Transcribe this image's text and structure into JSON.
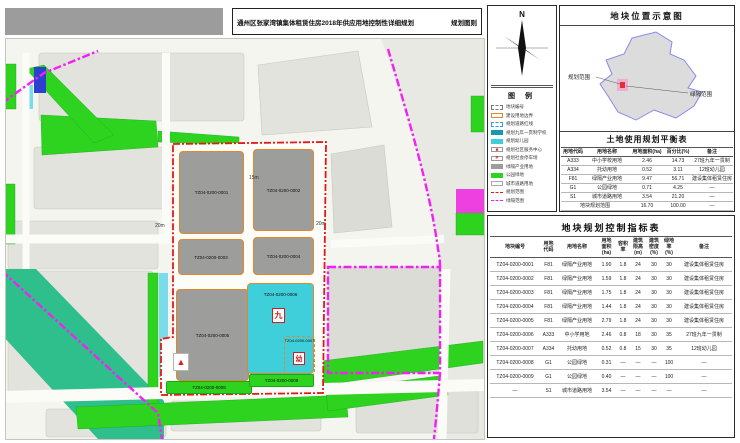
{
  "title_bar": {
    "title": "通州区张家湾镇集体租赁住房2018年供应用地控制性详细规划",
    "right_label": "规划图则"
  },
  "compass": {
    "n": "N"
  },
  "legend": {
    "title": "图  例",
    "items": [
      {
        "label": "地块编号",
        "sw": "sw-dash"
      },
      {
        "label": "建设用地边界",
        "sw": "sw-orange"
      },
      {
        "label": "规划道路红线",
        "sw": "sw-cyan-dash"
      },
      {
        "label": "规划九年一贯制学校",
        "sw": "sw-teal-dark"
      },
      {
        "label": "规划幼儿园",
        "sw": "sw-teal"
      },
      {
        "label": "规划社区服务中心",
        "sw": "sw-mark",
        "glyph": "■"
      },
      {
        "label": "规划社会停车场",
        "sw": "sw-mark",
        "glyph": "P"
      },
      {
        "label": "绿隔产业用地",
        "sw": "sw-gray"
      },
      {
        "label": "公园绿地",
        "sw": "sw-green"
      },
      {
        "label": "城市道路用地",
        "sw": "sw-road"
      },
      {
        "label": "规划范围",
        "sw": "sw-red-line"
      },
      {
        "label": "绿隔范围",
        "sw": "sw-magenta-line"
      }
    ]
  },
  "location_map": {
    "title": "地块位置示意图",
    "label_planning": "规划范围",
    "label_greenbelt": "绿隔范围"
  },
  "balance_table": {
    "title": "土地使用规划平衡表",
    "headers": [
      "用地代码",
      "用地名称",
      "用地面积(ha)",
      "百分比(%)",
      "备注"
    ],
    "rows": [
      [
        "A333",
        "中小学校用地",
        "2.46",
        "14.73",
        "27班九年一贯制"
      ],
      [
        "A334",
        "托幼用地",
        "0.52",
        "3.11",
        "12班幼儿园"
      ],
      [
        "F81",
        "绿隔产业用地",
        "9.47",
        "56.71",
        "建设集体租赁住房"
      ],
      [
        "G1",
        "公园绿地",
        "0.71",
        "4.25",
        "—"
      ],
      [
        "S1",
        "城市道路用地",
        "3.54",
        "21.20",
        "—"
      ],
      [
        {
          "t": "地块规划范围",
          "cs": 2
        },
        "16.70",
        "100.00",
        "—"
      ]
    ]
  },
  "index_table": {
    "title": "地块规划控制指标表",
    "headers": [
      "地块编号",
      "用地\n代码",
      "用地名称",
      "用地\n面积\n(ha)",
      "容积\n率",
      "建筑\n限高\n(m)",
      "建筑\n密度\n(%)",
      "绿地\n率\n(%)",
      "备注"
    ],
    "rows": [
      [
        "TZ04-0200-0001",
        "F81",
        "绿隔产业用地",
        "1.90",
        "1.8",
        "24",
        "30",
        "30",
        "建设集体租赁住房"
      ],
      [
        "TZ04-0200-0002",
        "F81",
        "绿隔产业用地",
        "1.59",
        "1.8",
        "24",
        "30",
        "30",
        "建设集体租赁住房"
      ],
      [
        "TZ04-0200-0003",
        "F81",
        "绿隔产业用地",
        "1.75",
        "1.8",
        "24",
        "30",
        "30",
        "建设集体租赁住房"
      ],
      [
        "TZ04-0200-0004",
        "F81",
        "绿隔产业用地",
        "1.44",
        "1.8",
        "24",
        "30",
        "30",
        "建设集体租赁住房"
      ],
      [
        "TZ04-0200-0005",
        "F81",
        "绿隔产业用地",
        "2.79",
        "1.8",
        "24",
        "30",
        "30",
        "建设集体租赁住房"
      ],
      [
        "TZ04-0200-0006",
        "A333",
        "中小学用地",
        "2.46",
        "0.8",
        "18",
        "30",
        "35",
        "27班九年一贯制"
      ],
      [
        "TZ04-0200-0007",
        "A334",
        "托幼用地",
        "0.52",
        "0.8",
        "15",
        "30",
        "35",
        "12班幼儿园"
      ],
      [
        "TZ04-0200-0008",
        "G1",
        "公园绿地",
        "0.31",
        "—",
        "—",
        "—",
        "100",
        "—"
      ],
      [
        "TZ04-0200-0009",
        "G1",
        "公园绿地",
        "0.40",
        "—",
        "—",
        "—",
        "100",
        "—"
      ],
      [
        "—",
        "S1",
        "城市道路用地",
        "3.54",
        "—",
        "—",
        "—",
        "—",
        "—"
      ]
    ]
  },
  "map": {
    "parcels": [
      {
        "code": "TZ04-0200-0001"
      },
      {
        "code": "TZ04-0200-0002"
      },
      {
        "code": "TZ04-0200-0003"
      },
      {
        "code": "TZ04-0200-0004"
      },
      {
        "code": "TZ04-0200-0005"
      },
      {
        "code": "TZ04-0200-0006"
      },
      {
        "code": "TZ04-0200-0007"
      },
      {
        "code": "TZ04-0200-0008"
      },
      {
        "code": "TZ04-0200-0009"
      }
    ],
    "markers": {
      "nine": "九",
      "kindergarten": "幼",
      "triangle": "▲"
    },
    "road_labels": {
      "a": "15m",
      "b": "20m",
      "c": "20m"
    },
    "colors": {
      "industry_gray": "#9d9d9b",
      "school_cyan": "#3fcfda",
      "park_green": "#2ed31f",
      "boundary_red": "#e61717",
      "greenbelt_magenta": "#f320f3",
      "parcel_border_orange": "#e2882a",
      "greenbelt_teal": "#2fbf8d"
    }
  }
}
